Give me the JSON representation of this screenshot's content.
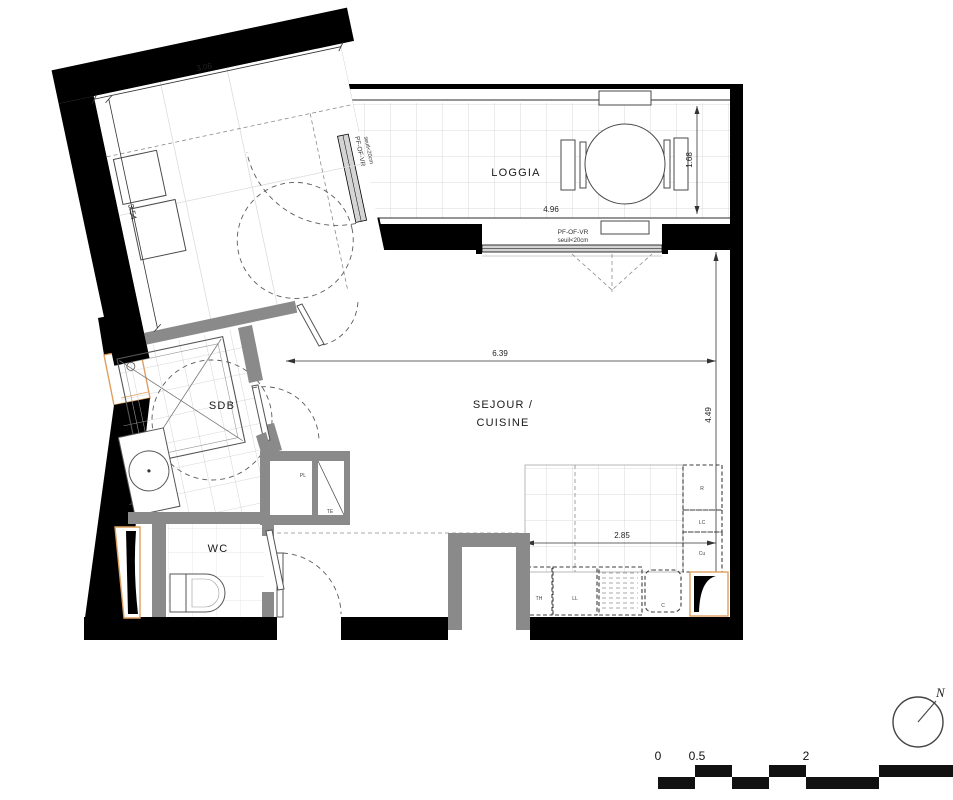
{
  "rooms": {
    "chambre": {
      "name": "CHAMBRE",
      "width": "3.06",
      "height": "3.54"
    },
    "loggia": {
      "name": "LOGGIA",
      "width": "4.96",
      "height": "1.68"
    },
    "sejour": {
      "name1": "SEJOUR /",
      "name2": "CUISINE",
      "width": "6.39",
      "height": "4.49"
    },
    "sdb": {
      "name": "SDB"
    },
    "wc": {
      "name": "WC"
    }
  },
  "kitchen": {
    "width": "2.85",
    "fridge": "R",
    "lc": "LC",
    "hob": "Cu",
    "th": "TH",
    "washer": "LL",
    "c": "C"
  },
  "closet": {
    "pl": "PL",
    "te": "TE"
  },
  "windows": {
    "sejour_window": {
      "type": "PF-OF-VR",
      "sill": "seuil<20cm"
    },
    "chambre_window": {
      "type": "PF-OF-VR",
      "sill": "seuil<20cm"
    }
  },
  "compass": {
    "label": "N"
  },
  "scale": {
    "zero": "0",
    "half": "0.5",
    "two": "2"
  },
  "colors": {
    "wall": "#000000",
    "partition": "#8a8a8a",
    "accent": "#dfa05f",
    "tile": "#cfcfcf"
  }
}
